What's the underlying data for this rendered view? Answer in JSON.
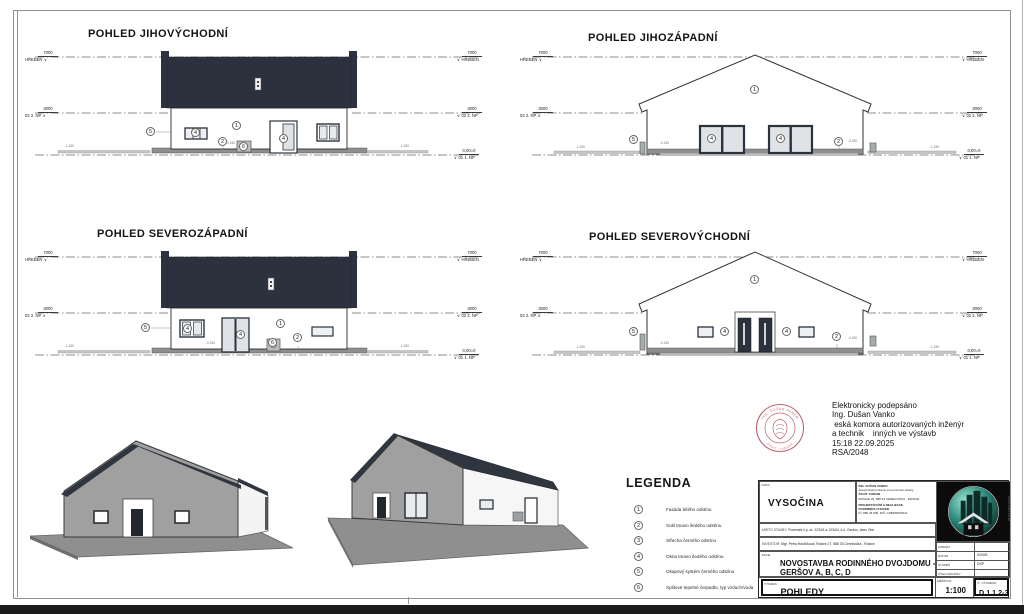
{
  "views": [
    {
      "title": "POHLED JIHOVÝCHODNÍ",
      "annotations": [
        "5",
        "4",
        "1",
        "2",
        "6",
        "4"
      ]
    },
    {
      "title": "POHLED JIHOZÁPADNÍ",
      "annotations": [
        "1",
        "5",
        "4",
        "4",
        "2"
      ]
    },
    {
      "title": "POHLED SEVEROZÁPADNÍ",
      "annotations": [
        "5",
        "4",
        "4",
        "1",
        "2",
        "6"
      ]
    },
    {
      "title": "POHLED SEVEROVÝCHODNÍ",
      "annotations": [
        "1",
        "5",
        "4",
        "4",
        "2"
      ]
    }
  ],
  "levels": {
    "ridge": {
      "value": "7000",
      "label": "HŘEBEN"
    },
    "floor2": {
      "value": "3000",
      "label": "02 2. NP"
    },
    "ground": {
      "value": "0,00=0",
      "label": "01 1. NP"
    }
  },
  "ground_tags": {
    "low": "-1,150",
    "zero": "-0,150"
  },
  "legend": {
    "title": "LEGENDA",
    "items": [
      {
        "num": "1",
        "text": "Fasáda bílého odstínu"
      },
      {
        "num": "2",
        "text": "Sokl tmavo šedého odstínu"
      },
      {
        "num": "3",
        "text": "Střecha černého odstínu"
      },
      {
        "num": "4",
        "text": "Okna tmavo šedého odstínu"
      },
      {
        "num": "5",
        "text": "Okapový systém černého odstínu"
      },
      {
        "num": "6",
        "text": "Splitové tepelné čerpadlo, typ vzduch/voda"
      }
    ]
  },
  "signature": {
    "lines": [
      "Elektronicky podepsáno",
      "Ing. Dušan Vanko",
      " eská komora autorizovaných inženýr",
      "a technik    inných ve výstavb",
      "15:18 22.09.2025",
      "RSA/2048"
    ],
    "stamp": {
      "name": "ING. DUŠAN VANKO",
      "number": "ČKAIT - 1400339",
      "color": "#b04a58"
    }
  },
  "titleblock": {
    "kraj_label": "KRAJ:",
    "kraj": "VYSOČINA",
    "engineer": {
      "line1": "ING. DUŠAN VANKO",
      "line2": "Autorizovaný inženýr pro pozemní stavby",
      "line3": "ČKAIT 1400339",
      "line4": "ROSICE 29, 588 33 CEREKVIČKA - ROSICE",
      "line5": "PROJEKTOVÁNÍ A REALIZACE",
      "line6": "POZEMNÍCH STAVEB",
      "line7": "IČ: 880 46 806, DIČ: CZ8905054541"
    },
    "misto_label": "MÍSTO STAVBY:",
    "misto": "Pozemek č.p. st. 1234/1 a 1234/4, k.ú. Geršov, obec Otín",
    "investor_label": "INVESTOR:",
    "investor": "Mgr. Petra Havlíčková, Rosice 27, 588 33 Cerekvička - Rosice",
    "akce_label": "AKCE:",
    "akce_line1": "NOVOSTAVBA RODINNÉHO DVOJDOMU -",
    "akce_line2": "GERŠOV A, B, C, D",
    "rows": [
      {
        "label": "FORMÁT",
        "value": ""
      },
      {
        "label": "DATUM",
        "value": "9/2025"
      },
      {
        "label": "STUPEŇ",
        "value": "DSP"
      },
      {
        "label": "ČÍSLO ZAKÁZKY",
        "value": "-"
      }
    ],
    "vykres_label": "VÝKRES:",
    "vykres": "POHLEDY",
    "meritko_label": "MĚŘÍTKO:",
    "meritko": "1:100",
    "cislo_label": "Č. VÝKRESU:",
    "cislo": "D.1.1.2-3",
    "side_note": "22.09.2025 15:18"
  },
  "colors": {
    "roof": "#2b323e",
    "plinth": "#8f8f8f",
    "glass": "#dfe3e6",
    "render_grey": "#a0a0a0",
    "stamp_red": "#b04a58",
    "logo_teal": "#2e8d7e"
  }
}
